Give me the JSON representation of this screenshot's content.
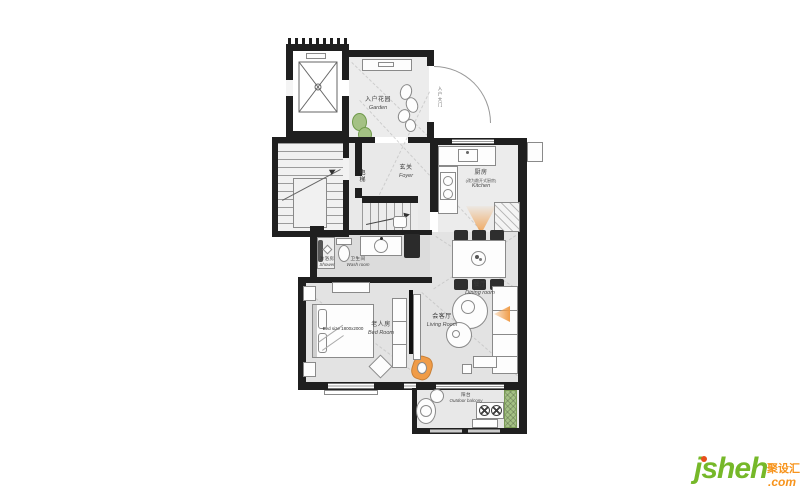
{
  "colors": {
    "wall": "#1f1f1f",
    "floor": "#e3e3e3",
    "floor-light": "#ececec",
    "bath-floor": "#dcdcdc",
    "accent": "#f09c48",
    "plant": "#a4c184",
    "logo-green": "#76b829",
    "logo-orange": "#f7941d",
    "logo-red": "#e84e1b"
  },
  "rooms": {
    "garden": {
      "cn": "入户花园",
      "en": "Garden"
    },
    "foyer": {
      "cn": "玄关",
      "en": "Foyer"
    },
    "elevator": {
      "cn": "电梯"
    },
    "entry": {
      "cn": "入户大门"
    },
    "kitchen": {
      "cn": "厨房",
      "note": "(改为敞开式厨房)",
      "en": "Kitchen"
    },
    "dining": {
      "cn": "餐厅",
      "en": "Dining room"
    },
    "living": {
      "cn": "会客厅",
      "en": "Living Room"
    },
    "bedroom": {
      "cn": "老人房",
      "en": "Bed Room",
      "bed": "Bed size 1800x2000"
    },
    "shower": {
      "cn": "淋浴房",
      "en": "Shower"
    },
    "washroom": {
      "cn": "卫生间",
      "en": "Wash room"
    },
    "balcony": {
      "cn": "阳台",
      "en": "Outdoor balcony"
    }
  },
  "watermark": {
    "brand": "jsheh",
    "tld": ".com",
    "cn": "聚设汇"
  }
}
